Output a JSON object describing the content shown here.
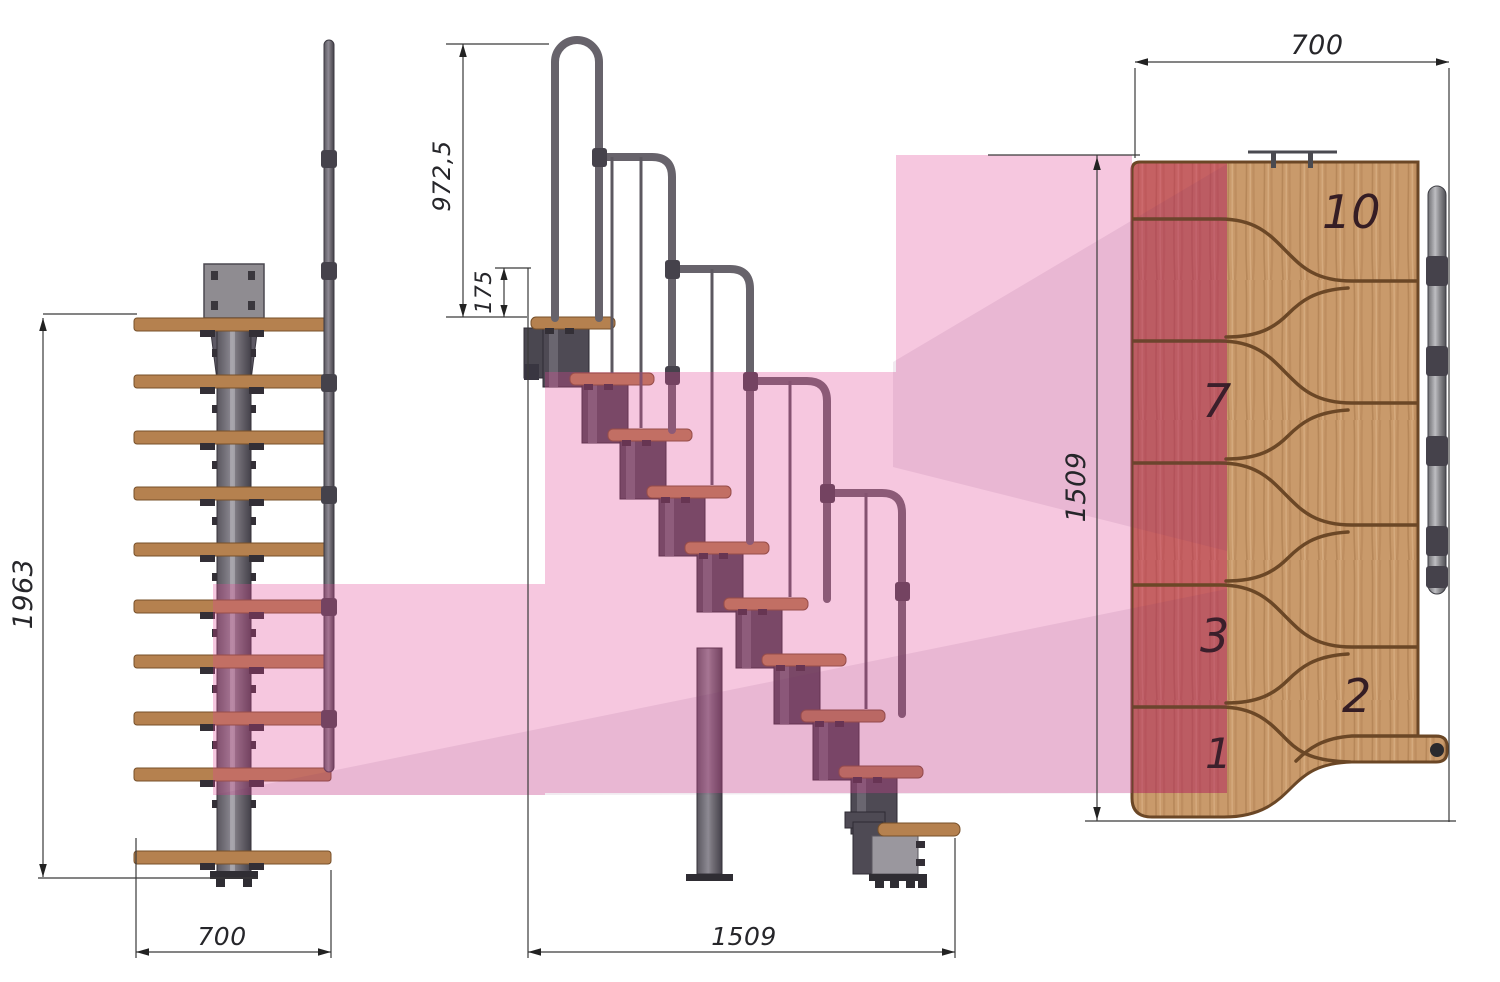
{
  "title": "Modular staircase dimensional drawing (three views)",
  "views": {
    "front": {
      "dim_height": "1963",
      "dim_width": "700"
    },
    "side": {
      "dim_rail_height": "972,5",
      "dim_top_rise": "175",
      "dim_run": "1509"
    },
    "top": {
      "dim_width": "700",
      "dim_run": "1509",
      "steps": [
        {
          "label": "10"
        },
        {
          "label": "7"
        },
        {
          "label": "3"
        },
        {
          "label": "2"
        },
        {
          "label": "1"
        }
      ]
    }
  },
  "colors": {
    "highlight_pink": "#f6cce4",
    "highlight_red": "#c4737f",
    "wood": "#c99a6b",
    "tread": "#b5814f",
    "metal": "#55525b",
    "dimension_line": "#333333"
  }
}
